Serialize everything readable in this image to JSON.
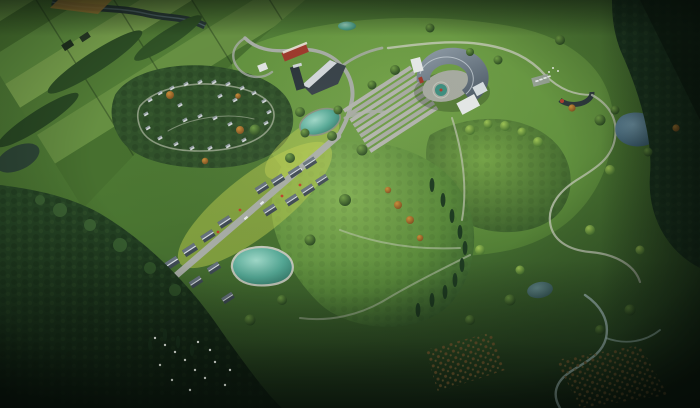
{
  "scene": {
    "description": "Aerial bird's-eye architectural rendering of a park masterplan at dusk: patchwork farmland and a river in the upper left, a looping cabin campground in forest, a crescent-shaped visitor center with a fan of plaza steps, a small arc pavilion with parking, a village street with gabled houses and a teal kidney pond, two rounded green hills, winding trails, a blue pond, white birds on a dark meadow and orchard rows in the dark lower right",
    "features": [
      "farmland-patchwork",
      "river",
      "hedgerow-farmhouses",
      "cabin-campground-loop",
      "crescent-visitor-center",
      "stepped-plaza",
      "courtyard-fountain",
      "red-building",
      "wedge-building",
      "arc-pavilion",
      "parking-cars",
      "village-street",
      "village-houses",
      "kidney-pond",
      "plaza-pond",
      "hill-top-pond",
      "blue-pond",
      "small-dark-pond",
      "green-hills",
      "conifer-trees",
      "autumn-trees",
      "winding-trails",
      "terraced-steps",
      "meadow-clearing",
      "white-birds",
      "orchard-rows",
      "dark-forest-edges"
    ]
  },
  "palette": {
    "base_green": "#4e7a33",
    "field_light": "#84ad55",
    "field_mid": "#5f8d3e",
    "field_dark": "#476f2e",
    "lawn_bright": "#b9cc4d",
    "hill_light": "#83b153",
    "forest": "#30512a",
    "forest_dark": "#1d3822",
    "forest_deep": "#132615",
    "road": "#a8ada6",
    "trail": "#c6cbb9",
    "stream": "#9fb7b4",
    "plaza": "#b3b5ae",
    "water_teal": "#54a895",
    "water_teal_light": "#9fd8c8",
    "water_blue": "#4b7495",
    "river_dark": "#26343a",
    "roof_slate": "#6b7884",
    "roof_light": "#9aa7b0",
    "wall_white": "#e6e9e8",
    "building_red": "#9e3b2d",
    "building_dark": "#39434a",
    "autumn_orange": "#b5772c",
    "soil_orange": "#b98a3a",
    "orchard_brown": "#6b512a",
    "bird_white": "#eef2ea",
    "flower_red": "#c0402a"
  }
}
